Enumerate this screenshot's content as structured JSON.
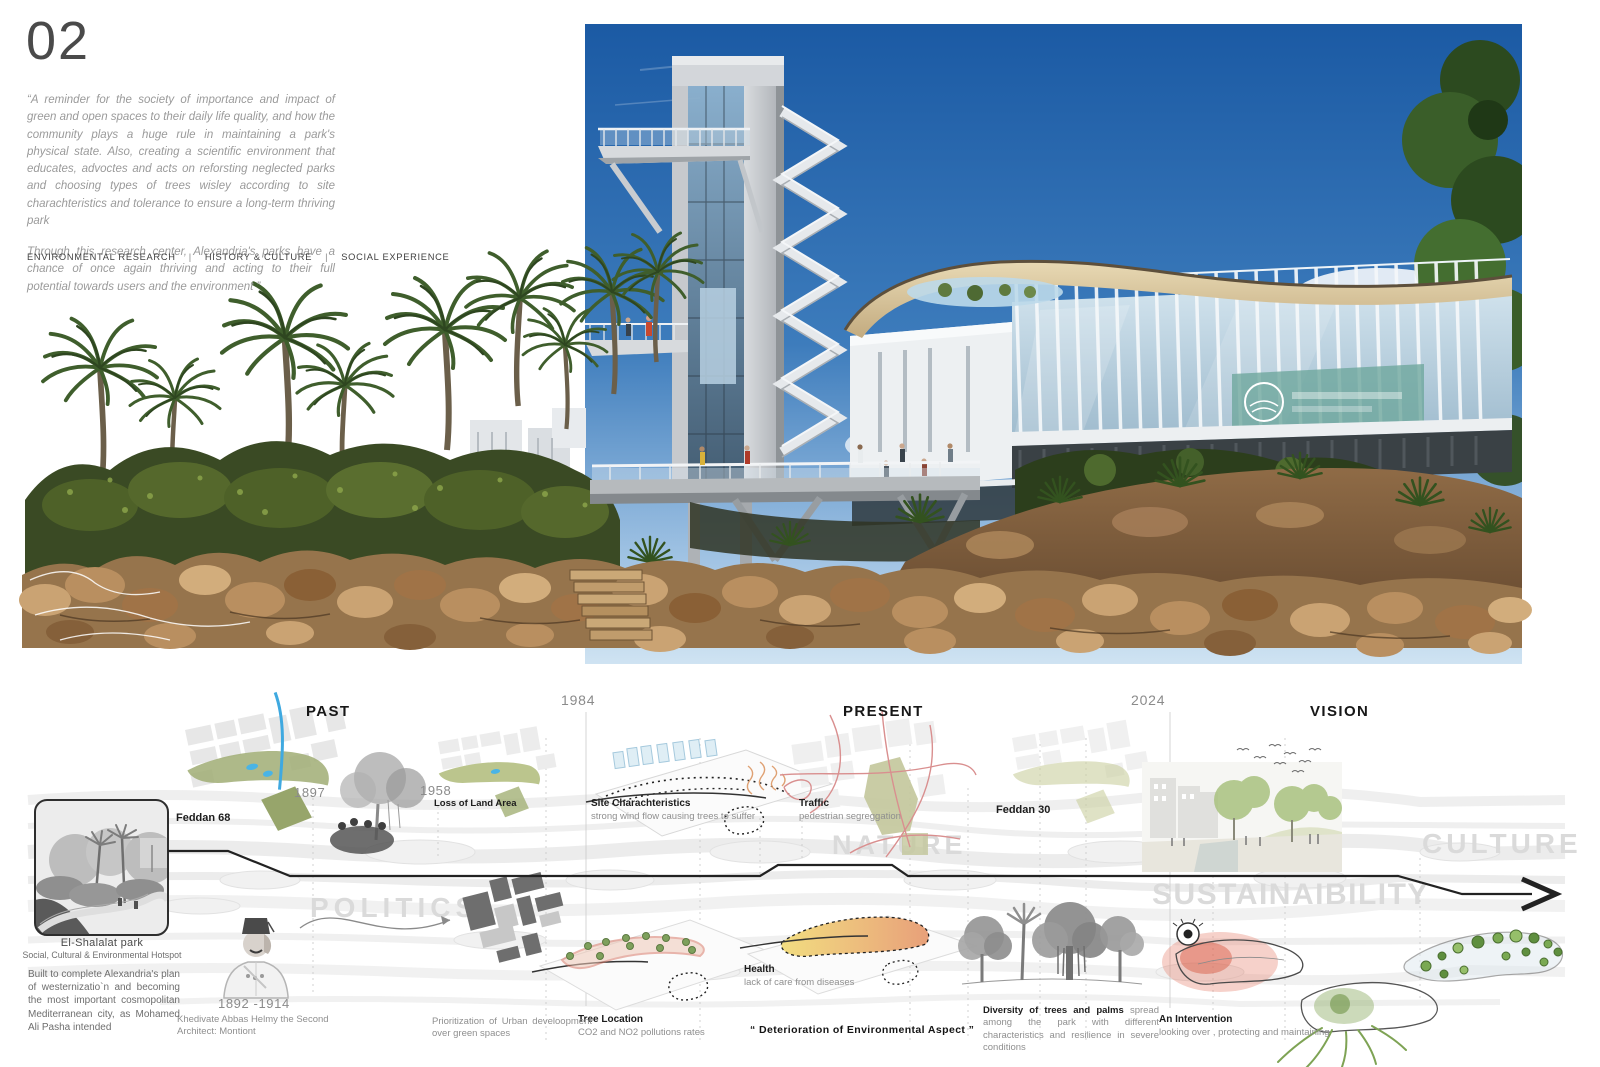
{
  "page": {
    "number": "02",
    "quote_p1": "“A reminder for the society of importance and impact of green and open spaces to their daily life quality, and how the community plays a huge rule in maintaining a park's physical state. Also, creating a scientific environment that educates, advoctes and acts on reforsting neglected parks and choosing types of trees wisley according to site charachteristics and tolerance to ensure a long-term thriving park",
    "quote_p2": "Through this research center, Alexandria's parks have a chance of once again thriving and acting to their full potential towards users and  the environment ”",
    "categories": [
      "ENVIRONMENTAL RESEARCH",
      "HISTORY & CULTURE",
      "SOCIAL EXPERIENCE"
    ],
    "category_separator": "|"
  },
  "timeline": {
    "sections": {
      "past": "PAST",
      "present": "PRESENT",
      "vision": "VISION"
    },
    "years": {
      "y1984": "1984",
      "y2024": "2024"
    },
    "watermarks": {
      "politics": "POLITICS",
      "nature": "NATURE",
      "sustainability": "SUSTAINAIBILITY",
      "culture": "CULTURE"
    },
    "events": {
      "feddan68": {
        "label": "Feddan 68"
      },
      "y1897": {
        "label": "1897"
      },
      "y1958": {
        "label": "1958",
        "sub": "Loss of Land Area"
      },
      "site_characteristics": {
        "title": "Site Charachteristics",
        "sub": "strong wind flow causing trees to suffer"
      },
      "traffic": {
        "title": "Traffic",
        "sub": "pedestrian segreggation"
      },
      "feddan30": {
        "label": "Feddan 30"
      },
      "health": {
        "title": "Health",
        "sub": "lack of care from diseases"
      },
      "tree_location": {
        "title": "Tree Location",
        "sub": "CO2 and NO2 pollutions rates"
      },
      "prioritization": {
        "text": "Prioritization of Urban develoopment over green spaces"
      },
      "deterioration": {
        "text": "“ Deterioration of Environmental Aspect ”"
      },
      "diversity": {
        "title": "Diversity of trees and palms",
        "sub": "spread among the park with different characteristics and resilience in severe conditions"
      },
      "intervention": {
        "title": "An Intervention",
        "sub": "looking over , protecting and maintaining"
      },
      "khedivate": {
        "years": "1892 -1914",
        "line1": "Khedivate Abbas Helmy the Second",
        "line2": "Architect: Montiont"
      }
    },
    "park_card": {
      "title": "El-Shalalat park",
      "subtitle": "Social, Cultural & Environmental Hotspot",
      "body": "Built to complete Alexandria's plan of westernizatio`n and becoming the most important cosmopolitan Mediterranean city, as Mohamed Ali Pasha intended"
    }
  },
  "icons": {
    "timeline_arrowhead": "chevron-right",
    "surveillance_eye": "eye",
    "birds": "flock-glyphs"
  },
  "colors": {
    "sky_top": "#1b5aa4",
    "sky_horizon": "#cfe3f2",
    "canopy_cream": "#d9c49a",
    "sign_teal": "#6fa89e",
    "foliage_dark": "#3a4a24",
    "rock_tan": "#b08a5d",
    "park_green": "#a0ad74",
    "canal_blue": "#3fa9e0",
    "road_red": "#d98f8f",
    "timeline_black": "#222222",
    "watermark_gray": "#dadada",
    "wind_orange": "#dfa173",
    "heat_yellow": "#f2dd80",
    "heat_orange": "#e8a07a",
    "alert_red": "#d95f4a",
    "intervention_green": "#7fa35c"
  }
}
